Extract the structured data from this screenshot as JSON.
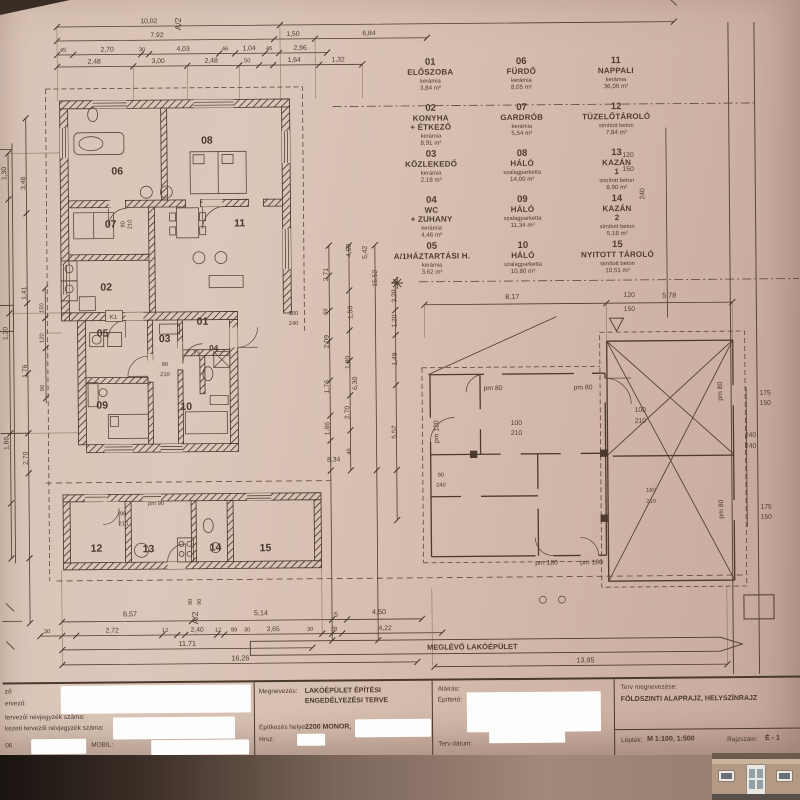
{
  "schedule": {
    "rooms": [
      {
        "num": "01",
        "name": "ELŐSZOBA",
        "name2": "",
        "floor": "kerámia",
        "area": "3,84 m²"
      },
      {
        "num": "02",
        "name": "KONYHA",
        "name2": "+ ÉTKEZŐ",
        "floor": "kerámia",
        "area": "8,91 m²"
      },
      {
        "num": "03",
        "name": "KÖZLEKEDŐ",
        "name2": "",
        "floor": "kerámia",
        "area": "2,18 m²"
      },
      {
        "num": "04",
        "name": "WC",
        "name2": "+ ZUHANY",
        "floor": "kerámia",
        "area": "4,46 m²"
      },
      {
        "num": "05",
        "name": "A/1HÁZTARTÁSI H.",
        "name2": "",
        "floor": "kerámia",
        "area": "3,62 m²"
      },
      {
        "num": "06",
        "name": "FÜRDŐ",
        "name2": "",
        "floor": "kerámia",
        "area": "8,05 m²"
      },
      {
        "num": "07",
        "name": "GARDRÓB",
        "name2": "",
        "floor": "kerámia",
        "area": "5,54 m²"
      },
      {
        "num": "08",
        "name": "HÁLÓ",
        "name2": "",
        "floor": "szalagparketta",
        "area": "14,00 m²"
      },
      {
        "num": "09",
        "name": "HÁLÓ",
        "name2": "",
        "floor": "szalagparketta",
        "area": "11,34 m²"
      },
      {
        "num": "10",
        "name": "HÁLÓ",
        "name2": "",
        "floor": "szalagparketta",
        "area": "10,80 m²"
      },
      {
        "num": "11",
        "name": "NAPPALI",
        "name2": "",
        "floor": "kerámia",
        "area": "36,09 m²"
      },
      {
        "num": "12",
        "name": "TÜZELŐTÁROLÓ",
        "name2": "",
        "floor": "simított beton",
        "area": "7,84 m²"
      },
      {
        "num": "13",
        "name": "KAZÁN",
        "name2": "1",
        "floor": "simított beton",
        "area": "8,90 m²"
      },
      {
        "num": "14",
        "name": "KAZÁN",
        "name2": "2",
        "floor": "simított beton",
        "area": "5,18 m²"
      },
      {
        "num": "15",
        "name": "NYITOTT TÁROLÓ",
        "name2": "",
        "floor": "simított beton",
        "area": "10,51 m²"
      }
    ]
  },
  "plan": {
    "existing_band": "MEGLÉVŐ LAKÓÉPÜLET",
    "axis": {
      "a2_top": "A/2",
      "a2_bottom": "A/2",
      "k1": "K1"
    },
    "dims_top": [
      "10,02",
      "7,92",
      "1,50",
      "6,84",
      "45",
      "2,70",
      "30",
      "4,03",
      "46",
      "1,04",
      "46",
      "2,96",
      "2,48",
      "3,00",
      "2,48",
      "50",
      "1,64",
      "1,32",
      "8,17",
      "5,78"
    ],
    "dims_left": [
      "1,30",
      "3,48",
      "1,41",
      "1,76",
      "1,86",
      "2,70",
      "150",
      "120",
      "1,20",
      "90"
    ],
    "dims_mid": [
      "4,50",
      "5,42",
      "2,71",
      "15,52",
      "1,50",
      "69",
      "2,09",
      "1,80",
      "1,76",
      "6,30",
      "2,70",
      "1,86",
      "3,20",
      "1,20",
      "1,49",
      "5,52",
      "8,34",
      "46"
    ],
    "dims_bottom": [
      "6,57",
      "5,14",
      "5",
      "4,50",
      "30",
      "2,72",
      "12",
      "2,40",
      "12",
      "89",
      "30",
      "3,65",
      "30",
      "28",
      "4,22",
      "11,71",
      "16,26",
      "13,95",
      "90",
      "90"
    ],
    "dims_right": [
      "120",
      "150",
      "240",
      "120",
      "150",
      "240",
      "240",
      "175",
      "150",
      "175",
      "150"
    ],
    "openings": [
      "90",
      "210",
      "100",
      "240",
      "90",
      "210",
      "75",
      "pm 90",
      "90",
      "210",
      "pm 80",
      "pm 80",
      "100",
      "210",
      "100",
      "210",
      "pm 180",
      "pm 180",
      "pm 120",
      "180",
      "210",
      "90",
      "240",
      "pm 80",
      "pm 80"
    ]
  },
  "titleblock": {
    "cell1": {
      "line1": "ző",
      "line2": "ervező:",
      "line3": "tervezői névjegyzék száma:",
      "line4": "kezeti tervezői névjegyzék száma:",
      "line5a": "06",
      "line5b": "MOBIL:"
    },
    "cell2": {
      "label1": "Megnevezés:",
      "value1a": "LAKÓÉPÜLET ÉPÍTÉSI",
      "value1b": "ENGEDÉLYEZÉSI TERVE",
      "label2": "Építkezés helye:",
      "value2": "2200 MONOR,",
      "label3": "Hrsz:"
    },
    "cell3": {
      "label1": "Aláírás:",
      "label2": "Építtető:",
      "label3": "Terv dátum:"
    },
    "cell4": {
      "label1": "Terv megnevezése:",
      "value1": "FÖLDSZINTI ALAPRAJZ, HELYSZÍNRAJZ",
      "label2": "Lépték:",
      "value2": "M 1:100, 1:500",
      "label3": "Rajzszám:",
      "value3": "É - 1"
    }
  }
}
